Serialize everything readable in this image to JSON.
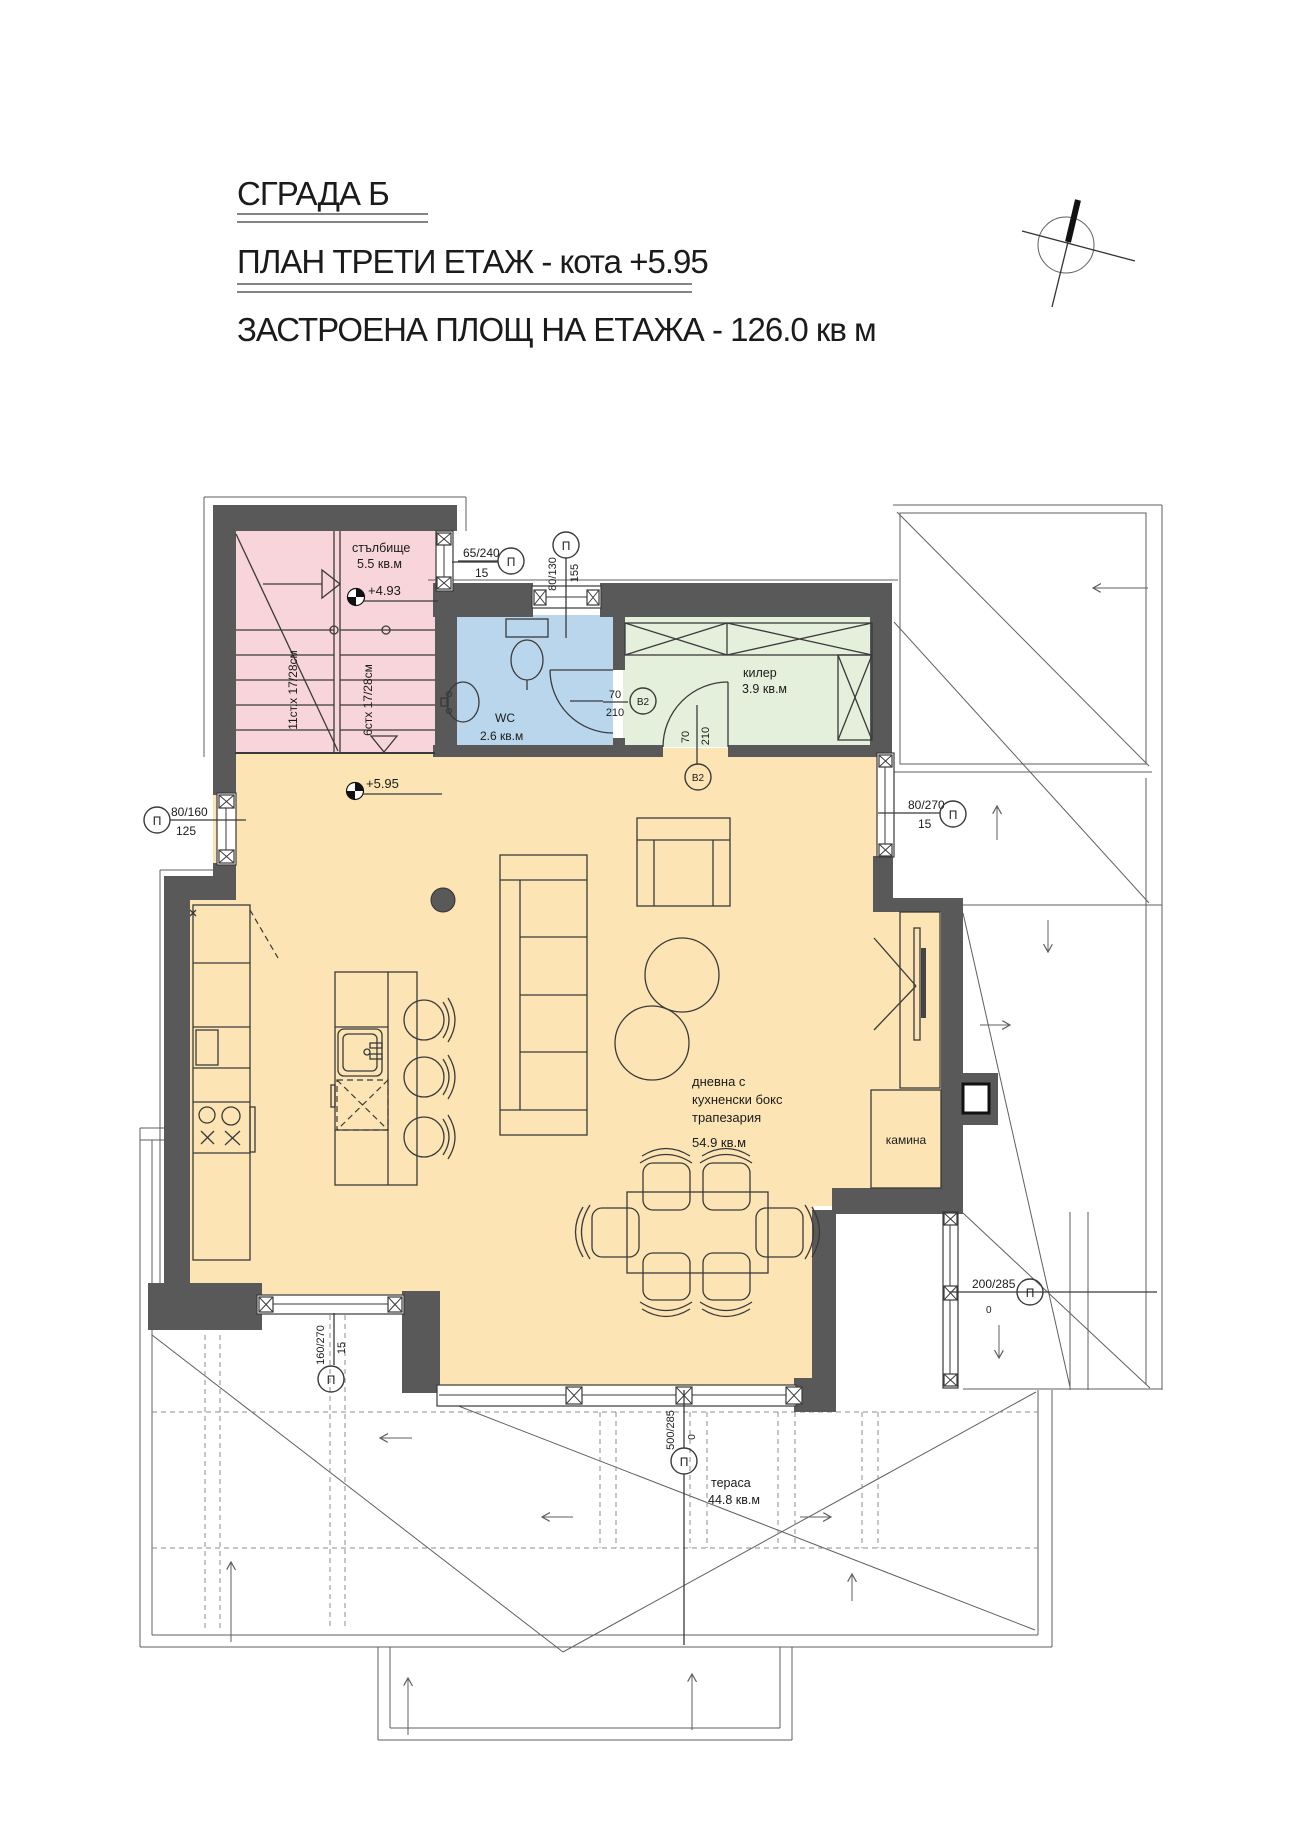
{
  "header": {
    "building": "СГРАДА Б",
    "plan": "ПЛАН ТРЕТИ ЕТАЖ - кота +5.95",
    "area": "ЗАСТРОЕНА ПЛОЩ НА ЕТАЖА - 126.0 кв м"
  },
  "rooms": {
    "staircase": {
      "name": "стълбище",
      "area": "5.5 кв.м"
    },
    "wc": {
      "name": "WC",
      "area": "2.6 кв.м"
    },
    "storage": {
      "name": "килер",
      "area": "3.9 кв.м"
    },
    "living": {
      "name_line1": "дневна с",
      "name_line2": "кухненски бокс",
      "name_line3": "трапезария",
      "area": "54.9 кв.м"
    },
    "fireplace": {
      "name": "камина"
    },
    "terrace": {
      "name": "тераса",
      "area": "44.8 кв.м"
    }
  },
  "levels": {
    "stair_landing": "+4.93",
    "floor": "+5.95"
  },
  "stairs": {
    "flight_long": "11ст.х 17/28см",
    "flight_short": "6стх 17/28см"
  },
  "openings": {
    "p1": {
      "tag": "П",
      "size": "65/240",
      "sill": "15"
    },
    "p2": {
      "tag": "П",
      "size": "80/130",
      "sill": "155"
    },
    "p3": {
      "tag": "П",
      "size": "80/160",
      "sill": "125"
    },
    "p4": {
      "tag": "П",
      "size": "160/270",
      "sill": "15"
    },
    "p5": {
      "tag": "П",
      "size": "80/270",
      "sill": "15"
    },
    "p6": {
      "tag": "П",
      "size": "200/285",
      "sill": "0"
    },
    "p7": {
      "tag": "П",
      "size": "500/285",
      "sill": "0"
    }
  },
  "doors": {
    "d1": {
      "tag": "В2",
      "width": "70",
      "height": "210"
    },
    "d2": {
      "tag": "В2",
      "width": "70",
      "height": "210"
    }
  },
  "colors": {
    "wall": "#595959",
    "stair": "#f7d5da",
    "wc": "#b9d6ec",
    "storage": "#e4efdc",
    "living": "#fce4b4",
    "paper": "#ffffff",
    "line": "#3a3a3a"
  }
}
